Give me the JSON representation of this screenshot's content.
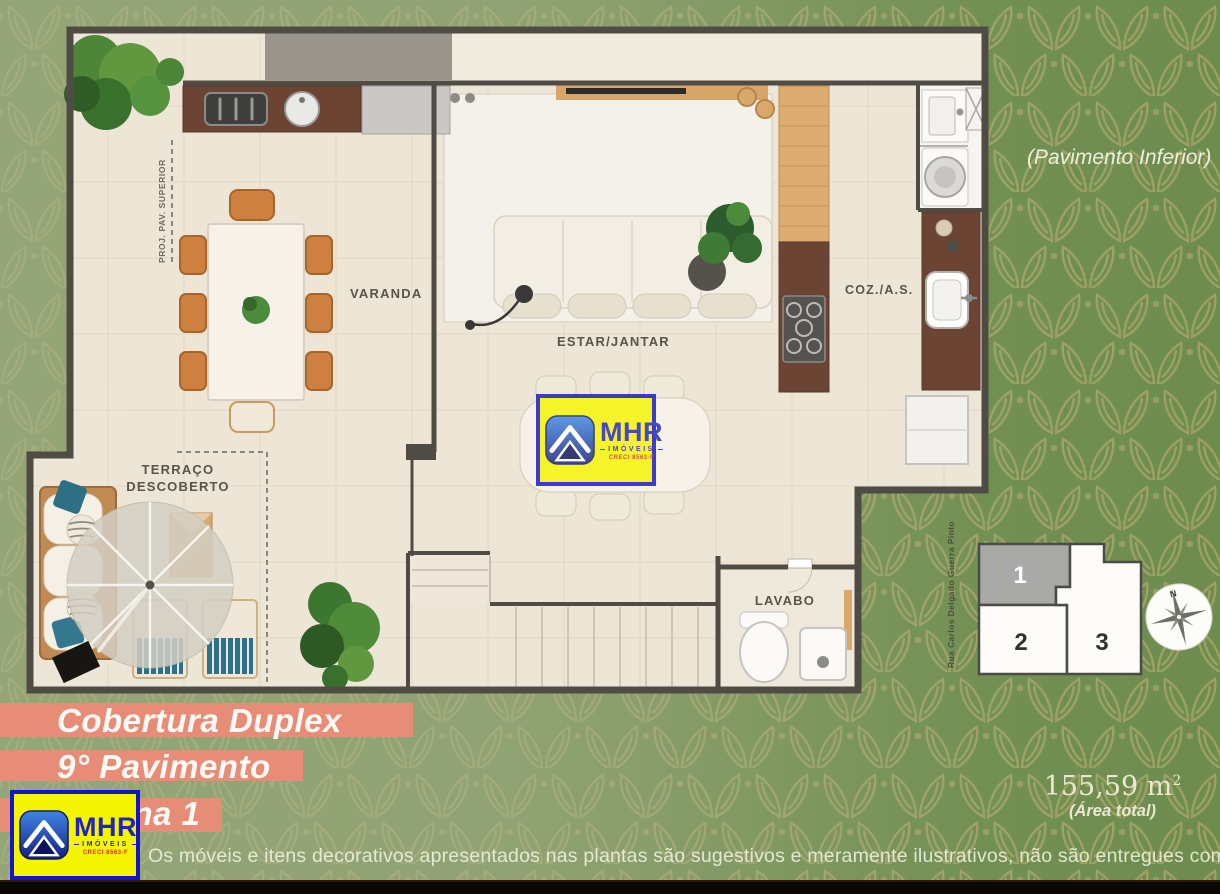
{
  "background": {
    "base_green": "#6d8c4e",
    "leaf_color": "#a8a566",
    "overlay_sage": "#a8b28c"
  },
  "header": {
    "note": "(Pavimento Inferior)"
  },
  "floorplan": {
    "rooms": {
      "varanda": "VARANDA",
      "estar_jantar": "ESTAR/JANTAR",
      "coz_as": "COZ./A.S.",
      "terraco_line1": "TERRAÇO",
      "terraco_line2": "DESCOBERTO",
      "lavabo": "LAVABO",
      "proj_pav_superior": "PROJ. PAV. SUPERIOR"
    }
  },
  "keyplan": {
    "street": "Rua Carlos Delgado Guerra Pinto",
    "unit1": "1",
    "unit2": "2",
    "unit3": "3",
    "compass_north": "N"
  },
  "area": {
    "value": "155,59 m",
    "superscript": "2",
    "label": "(Área total)"
  },
  "title": {
    "line1": "Cobertura Duplex",
    "line2": "9° Pavimento",
    "line3": "Coluna 1",
    "bar_color": "#e78c77"
  },
  "logo": {
    "name": "MHR",
    "subtitle": "IMÓVEIS",
    "creci": "CRECI 8563-F"
  },
  "disclaimer": "Os móveis e itens decorativos apresentados nas plantas são sugestivos e meramente ilustrativos, não são entregues com a unidade."
}
